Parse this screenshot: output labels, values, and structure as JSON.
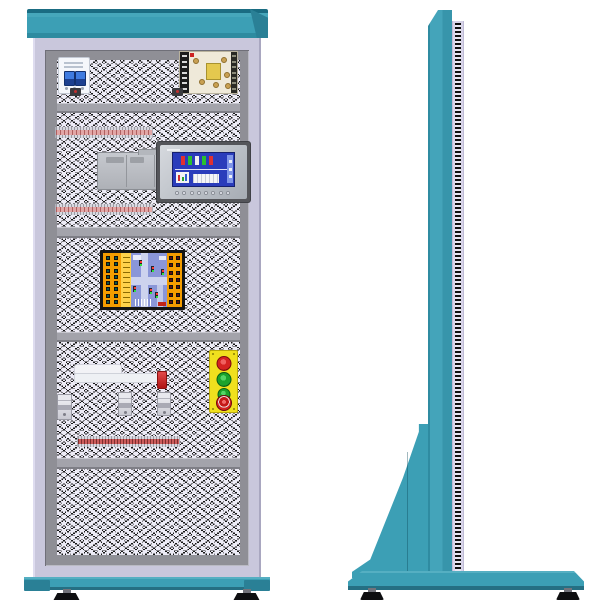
{
  "diagram": {
    "type": "technical-equipment-drawing",
    "subject": "electrical-training-control-cabinet",
    "views": [
      {
        "name": "front-view"
      },
      {
        "name": "side-view"
      }
    ]
  },
  "palette": {
    "cabinet_teal": "#3C9FB5",
    "teal_shadow": "#2A8096",
    "frame_lavender": "#C9C7DC",
    "frame_gray": "#8F8F96",
    "mesh_light": "#EDEBF6",
    "mesh_dark": "#161616",
    "duct_pink": "#E2A6A6",
    "duct_red": "#CC5C5C",
    "hmi_screen_blue": "#2A3CBB",
    "board_orange": "#F59D00",
    "board_blue": "#8A96D8",
    "button_yellow": "#F0E01E",
    "button_red": "#D42222",
    "button_green": "#1CA32C",
    "psu_board": "#EFE9D9",
    "transformer_yellow": "#E4C84E"
  },
  "front_view": {
    "sections": [
      {
        "name": "top-equipment-row",
        "components": [
          "miniature-circuit-breaker",
          "switching-power-supply",
          "cable-clamp",
          "cable-clamp"
        ]
      },
      {
        "name": "control-row",
        "components": [
          "wiring-duct",
          "plc-module",
          "hmi-touch-panel",
          "wiring-duct"
        ]
      },
      {
        "name": "trainer-row",
        "components": [
          "traffic-light-training-board"
        ]
      },
      {
        "name": "io-row",
        "components": [
          "relay-block",
          "red-indicator",
          "din-device",
          "din-device",
          "din-device",
          "pushbutton-station",
          "wiring-duct"
        ]
      },
      {
        "name": "blank-mesh-row",
        "components": []
      }
    ],
    "power_supply": {
      "terminal_rows": 7,
      "capacitor_count": 6
    },
    "hmi": {
      "function_keys": 8,
      "screen_color": "#2A3CBB"
    },
    "traffic_board": {
      "left_terminal_count": 16,
      "right_terminal_count": 14,
      "label_strip_rows": 10,
      "signal_count": 6
    },
    "pushbutton_station": {
      "screw_count": 4,
      "buttons": [
        {
          "name": "red-pushbutton",
          "color": "#D42222"
        },
        {
          "name": "green-pushbutton",
          "color": "#1CA32C"
        },
        {
          "name": "green-pushbutton-small",
          "color": "#1CA32C"
        },
        {
          "name": "emergency-stop-button",
          "color": "#D42222"
        }
      ]
    },
    "divider_rail_count": 4,
    "leveling_feet": 2
  },
  "side_view": {
    "parts": [
      "side-column",
      "panel-edge-strip",
      "support-gusset",
      "floor-base",
      "leveling-foot",
      "leveling-foot"
    ],
    "edge_strip_slot_count": 90,
    "leveling_feet": 2
  }
}
